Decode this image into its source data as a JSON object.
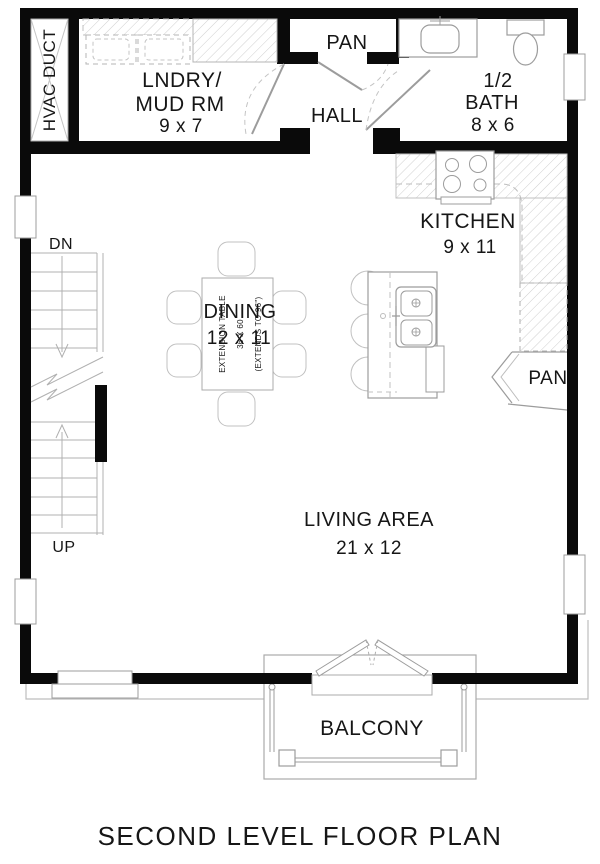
{
  "plan_title": "SECOND LEVEL FLOOR PLAN",
  "rooms": {
    "hvac": {
      "label": "HVAC DUCT"
    },
    "laundry": {
      "line1": "LNDRY/",
      "line2": "MUD RM",
      "dims": "9 x 7"
    },
    "pantry_top": {
      "label": "PAN"
    },
    "hall": {
      "label": "HALL"
    },
    "half_bath": {
      "line1": "1/2",
      "line2": "BATH",
      "dims": "8 x 6"
    },
    "kitchen": {
      "label": "KITCHEN",
      "dims": "9 x 11"
    },
    "dining": {
      "label": "DINING",
      "dims": "12 x 11"
    },
    "pantry_right": {
      "label": "PAN"
    },
    "living": {
      "label": "LIVING AREA",
      "dims": "21 x 12"
    },
    "balcony": {
      "label": "BALCONY"
    }
  },
  "stairs": {
    "down_label": "DN",
    "up_label": "UP"
  },
  "dining_table_note": {
    "line1": "EXTENSION TABLE",
    "line2": "36 X 60",
    "line3": "(EXTENDS TO 96\")"
  },
  "colors": {
    "wall": "#0a0a0a",
    "furniture_line": "#9c9c9c",
    "hatch": "#cfcfcf",
    "text": "#161616",
    "background": "#ffffff"
  }
}
